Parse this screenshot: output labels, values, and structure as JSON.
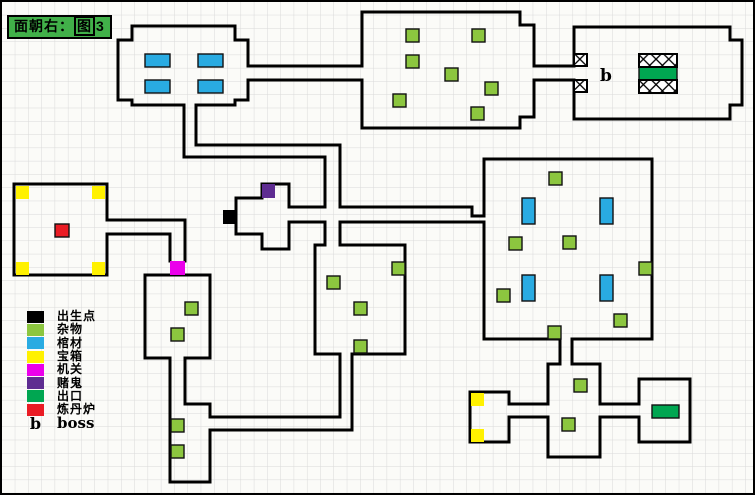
{
  "title": {
    "prefix": "面朝右：",
    "boxed": "图",
    "suffix": "3"
  },
  "colors": {
    "spawn": "#000000",
    "misc": "#8cc63f",
    "coffin": "#29abe2",
    "chest": "#fff100",
    "mechanism": "#eb00eb",
    "gambler": "#5e2c91",
    "exit": "#00a651",
    "furnace": "#ea1c24",
    "wall": "#000000",
    "grid_line": "#d9d9d9",
    "title_bg": "#41b049"
  },
  "legend": {
    "items": [
      {
        "key": "spawn",
        "label": "出生点"
      },
      {
        "key": "misc",
        "label": "杂物"
      },
      {
        "key": "coffin",
        "label": "棺材"
      },
      {
        "key": "chest",
        "label": "宝箱"
      },
      {
        "key": "mechanism",
        "label": "机关"
      },
      {
        "key": "gambler",
        "label": "赌鬼"
      },
      {
        "key": "exit",
        "label": "出口"
      },
      {
        "key": "furnace",
        "label": "炼丹炉"
      },
      {
        "key": "boss",
        "label": "boss",
        "symbol": "b"
      }
    ]
  },
  "map": {
    "boss_marker": {
      "label": "b",
      "x": 598,
      "y": 79
    },
    "walls": [
      {
        "name": "room-coffin-top",
        "d": "M130,24 H233 V38 H246 V64"
      },
      {
        "name": "room-coffin-bottom-right",
        "d": "M246,78 V98 H233 V103 H194"
      },
      {
        "name": "room-coffin-left",
        "d": "M182,103 H130 V98 H116 V38 H130 V24"
      },
      {
        "name": "corridor-coffin-storage-top",
        "d": "M246,64 H360"
      },
      {
        "name": "corridor-coffin-storage-bottom",
        "d": "M246,78 H360"
      },
      {
        "name": "room-storage-top",
        "d": "M360,64 V10 H518 V23 H532 V64"
      },
      {
        "name": "room-storage-bottom",
        "d": "M532,78 V115 H518 V126 H360 V78"
      },
      {
        "name": "corridor-storage-boss-top",
        "d": "M532,64 H572"
      },
      {
        "name": "corridor-storage-boss-bottom",
        "d": "M532,78 H572"
      },
      {
        "name": "room-boss",
        "d": "M572,64 V25 H728 V38 H740 V103 H728 V117 H572 V78"
      },
      {
        "name": "corridor-north-shaft-right",
        "d": "M194,103 V143 H338 V205"
      },
      {
        "name": "corridor-north-shaft-left",
        "d": "M182,103 V155 H323 V205"
      },
      {
        "name": "corridor-cross-left-lower",
        "d": "M323,220 V243"
      },
      {
        "name": "corridor-cross-right-lower",
        "d": "M338,220 V243"
      },
      {
        "name": "corridor-central-east-top-left",
        "d": "M287,205 H323"
      },
      {
        "name": "corridor-central-east-top-right",
        "d": "M338,205 H470 V214 H482"
      },
      {
        "name": "corridor-central-east-bottom-left",
        "d": "M287,220 H323"
      },
      {
        "name": "corridor-central-east-bottom-right",
        "d": "M338,220 H482"
      },
      {
        "name": "room-furnace",
        "d": "M105,218 V182 H12 V273 H105 V232"
      },
      {
        "name": "corridor-furnace-top",
        "d": "M105,218 H183 V259"
      },
      {
        "name": "corridor-furnace-bottom",
        "d": "M105,232 H168 V259"
      },
      {
        "name": "room-mid-left-right",
        "d": "M143,273 H208 V356 H183"
      },
      {
        "name": "room-mid-left-left",
        "d": "M168,356 H143 V273"
      },
      {
        "name": "room-lower-shaft-left",
        "d": "M168,356 V480 H208 V428"
      },
      {
        "name": "room-lower-shaft-right",
        "d": "M183,356 V402 H208 V415"
      },
      {
        "name": "corridor-south-top",
        "d": "M208,415 H338 V352"
      },
      {
        "name": "corridor-south-bottom",
        "d": "M208,428 H350 V352"
      },
      {
        "name": "room-mid-bottom-top-left",
        "d": "M313,243 H323"
      },
      {
        "name": "room-mid-bottom-right",
        "d": "M338,243 H403 V352 H350"
      },
      {
        "name": "room-mid-bottom-left",
        "d": "M338,352 H313 V243"
      },
      {
        "name": "room-central",
        "d": "M287,205 V182 H260 V196 H234 V232 H260 V247 H287 V220"
      },
      {
        "name": "room-big-right-outline",
        "d": "M482,214 V157 H650 V337 H570"
      },
      {
        "name": "room-big-right-bottom-left",
        "d": "M558,337 H482 V221"
      },
      {
        "name": "corridor-big-down-left",
        "d": "M558,337 V362"
      },
      {
        "name": "corridor-big-down-right",
        "d": "M570,337 V362"
      },
      {
        "name": "room-se-center-top-right",
        "d": "M570,362 H598 V402"
      },
      {
        "name": "room-se-center-bottom",
        "d": "M598,415 V455 H546 V415"
      },
      {
        "name": "room-se-center-top-left",
        "d": "M546,402 V362 H558"
      },
      {
        "name": "corridor-se-west-top",
        "d": "M507,402 H546"
      },
      {
        "name": "corridor-se-west-bottom",
        "d": "M507,415 H546"
      },
      {
        "name": "corridor-se-east-top",
        "d": "M598,402 H637"
      },
      {
        "name": "corridor-se-east-bottom",
        "d": "M598,415 H637"
      },
      {
        "name": "room-se-chest",
        "d": "M507,402 V390 H468 V440 H507 V415"
      },
      {
        "name": "room-se-exit",
        "d": "M637,402 V377 H688 V440 H637 V415"
      }
    ],
    "items": [
      {
        "t": "coffin",
        "x": 143,
        "y": 52,
        "w": 25,
        "h": 13
      },
      {
        "t": "coffin",
        "x": 196,
        "y": 52,
        "w": 25,
        "h": 13
      },
      {
        "t": "coffin",
        "x": 143,
        "y": 78,
        "w": 25,
        "h": 13
      },
      {
        "t": "coffin",
        "x": 196,
        "y": 78,
        "w": 25,
        "h": 13
      },
      {
        "t": "coffin",
        "x": 520,
        "y": 196,
        "w": 13,
        "h": 26
      },
      {
        "t": "coffin",
        "x": 598,
        "y": 196,
        "w": 13,
        "h": 26
      },
      {
        "t": "coffin",
        "x": 520,
        "y": 273,
        "w": 13,
        "h": 26
      },
      {
        "t": "coffin",
        "x": 598,
        "y": 273,
        "w": 13,
        "h": 26
      },
      {
        "t": "misc",
        "x": 404,
        "y": 27,
        "w": 13,
        "h": 13
      },
      {
        "t": "misc",
        "x": 470,
        "y": 27,
        "w": 13,
        "h": 13
      },
      {
        "t": "misc",
        "x": 404,
        "y": 53,
        "w": 13,
        "h": 13
      },
      {
        "t": "misc",
        "x": 443,
        "y": 66,
        "w": 13,
        "h": 13
      },
      {
        "t": "misc",
        "x": 483,
        "y": 80,
        "w": 13,
        "h": 13
      },
      {
        "t": "misc",
        "x": 391,
        "y": 92,
        "w": 13,
        "h": 13
      },
      {
        "t": "misc",
        "x": 469,
        "y": 105,
        "w": 13,
        "h": 13
      },
      {
        "t": "misc",
        "x": 547,
        "y": 170,
        "w": 13,
        "h": 13
      },
      {
        "t": "misc",
        "x": 507,
        "y": 235,
        "w": 13,
        "h": 13
      },
      {
        "t": "misc",
        "x": 561,
        "y": 234,
        "w": 13,
        "h": 13
      },
      {
        "t": "misc",
        "x": 637,
        "y": 260,
        "w": 13,
        "h": 13
      },
      {
        "t": "misc",
        "x": 495,
        "y": 287,
        "w": 13,
        "h": 13
      },
      {
        "t": "misc",
        "x": 612,
        "y": 312,
        "w": 13,
        "h": 13
      },
      {
        "t": "misc",
        "x": 546,
        "y": 324,
        "w": 13,
        "h": 13
      },
      {
        "t": "misc",
        "x": 390,
        "y": 260,
        "w": 13,
        "h": 13
      },
      {
        "t": "misc",
        "x": 325,
        "y": 274,
        "w": 13,
        "h": 13
      },
      {
        "t": "misc",
        "x": 352,
        "y": 300,
        "w": 13,
        "h": 13
      },
      {
        "t": "misc",
        "x": 352,
        "y": 338,
        "w": 13,
        "h": 13
      },
      {
        "t": "misc",
        "x": 183,
        "y": 300,
        "w": 13,
        "h": 13
      },
      {
        "t": "misc",
        "x": 169,
        "y": 326,
        "w": 13,
        "h": 13
      },
      {
        "t": "misc",
        "x": 169,
        "y": 417,
        "w": 13,
        "h": 13
      },
      {
        "t": "misc",
        "x": 169,
        "y": 443,
        "w": 13,
        "h": 13
      },
      {
        "t": "misc",
        "x": 572,
        "y": 377,
        "w": 13,
        "h": 13
      },
      {
        "t": "misc",
        "x": 560,
        "y": 416,
        "w": 13,
        "h": 13
      },
      {
        "t": "chest",
        "x": 14,
        "y": 184,
        "w": 13,
        "h": 13
      },
      {
        "t": "chest",
        "x": 90,
        "y": 184,
        "w": 13,
        "h": 13
      },
      {
        "t": "chest",
        "x": 14,
        "y": 260,
        "w": 13,
        "h": 13
      },
      {
        "t": "chest",
        "x": 90,
        "y": 260,
        "w": 13,
        "h": 13
      },
      {
        "t": "chest",
        "x": 469,
        "y": 391,
        "w": 13,
        "h": 13
      },
      {
        "t": "chest",
        "x": 469,
        "y": 427,
        "w": 13,
        "h": 13
      },
      {
        "t": "mechanism",
        "x": 168,
        "y": 259,
        "w": 15,
        "h": 14
      },
      {
        "t": "gambler",
        "x": 260,
        "y": 182,
        "w": 13,
        "h": 14
      },
      {
        "t": "spawn",
        "x": 221,
        "y": 208,
        "w": 13,
        "h": 14
      },
      {
        "t": "furnace",
        "x": 53,
        "y": 222,
        "w": 14,
        "h": 13
      },
      {
        "t": "exit",
        "x": 650,
        "y": 403,
        "w": 27,
        "h": 13
      },
      {
        "t": "exit",
        "x": 637,
        "y": 65,
        "w": 38,
        "h": 13
      }
    ],
    "hatches": [
      {
        "x": 572,
        "y": 52,
        "w": 13,
        "h": 12
      },
      {
        "x": 572,
        "y": 78,
        "w": 13,
        "h": 12
      },
      {
        "x": 637,
        "y": 52,
        "w": 38,
        "h": 13
      },
      {
        "x": 637,
        "y": 78,
        "w": 38,
        "h": 13
      }
    ]
  }
}
